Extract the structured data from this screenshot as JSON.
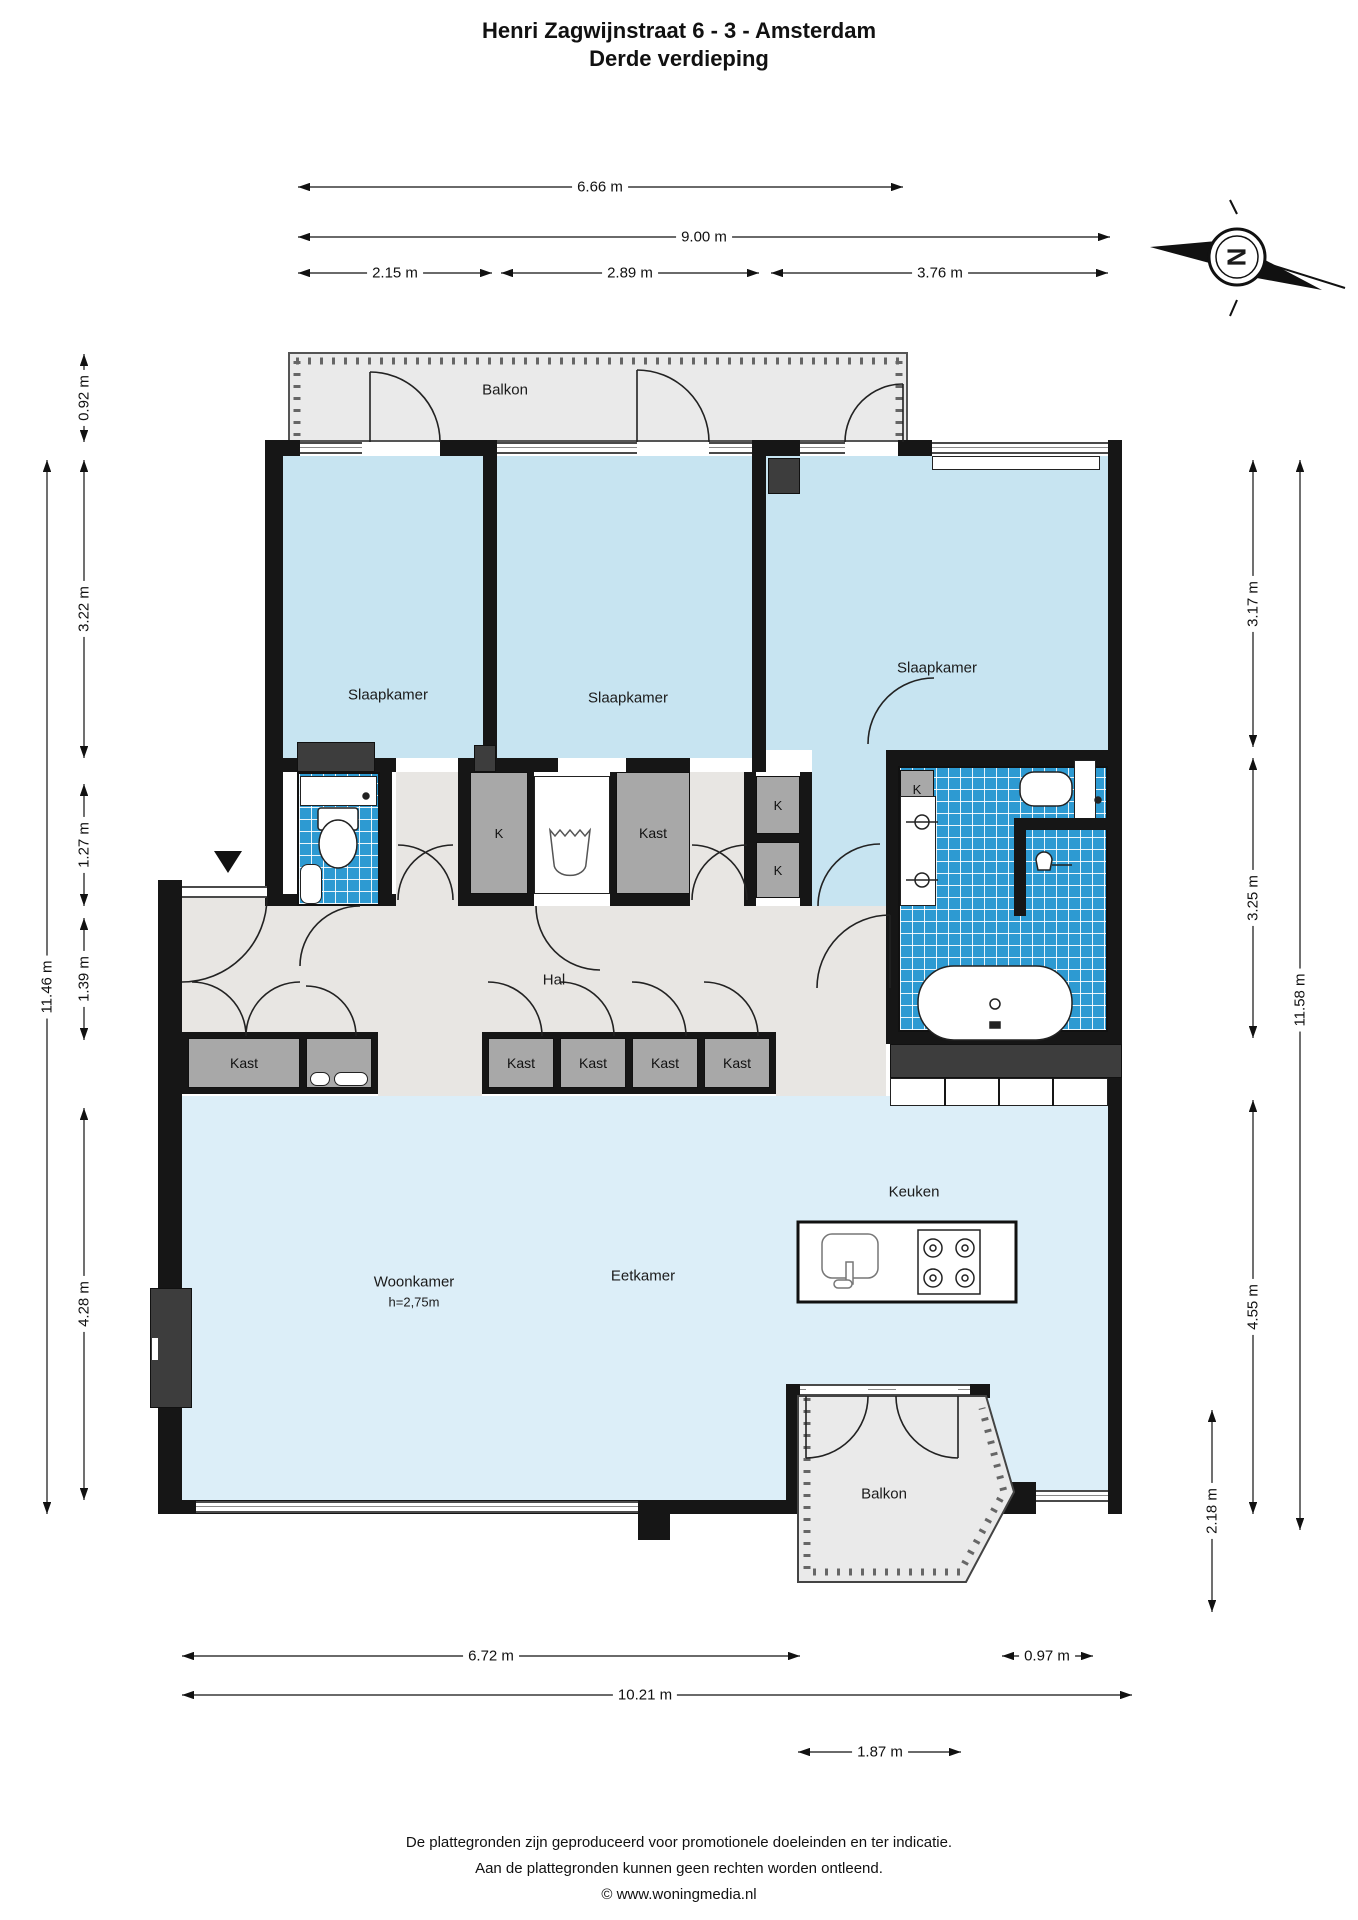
{
  "title": {
    "line1": "Henri Zagwijnstraat 6 - 3 - Amsterdam",
    "line2": "Derde verdieping"
  },
  "compass": {
    "letter": "N"
  },
  "rooms": {
    "balcony_top": "Balkon",
    "bedroom1": "Slaapkamer",
    "bedroom2": "Slaapkamer",
    "bedroom3": "Slaapkamer",
    "hall": "Hal",
    "living": "Woonkamer",
    "living_height": "h=2,75m",
    "dining": "Eetkamer",
    "kitchen": "Keuken",
    "balcony_bottom": "Balkon"
  },
  "closets": {
    "kast": "Kast",
    "k": "K"
  },
  "dimensions": {
    "top": {
      "balcony_width": "6.66 m",
      "total_width": "9.00 m",
      "bedroom1": "2.15 m",
      "bedroom2": "2.89 m",
      "bedroom3": "3.76 m"
    },
    "left": {
      "balcony_depth": "0.92 m",
      "bedrooms": "3.22 m",
      "closet_strip": "1.27 m",
      "hall": "1.39 m",
      "total": "11.46 m",
      "living": "4.28 m"
    },
    "right": {
      "bedroom3": "3.17 m",
      "bathroom": "3.25 m",
      "total": "11.58 m",
      "living": "4.55 m",
      "balcony": "2.18 m"
    },
    "bottom": {
      "living_width": "6.72 m",
      "total": "10.21 m",
      "window": "0.97 m",
      "balcony": "1.87 m"
    }
  },
  "footer": {
    "line1": "De plattegronden zijn geproduceerd voor promotionele doeleinden en ter indicatie.",
    "line2": "Aan de plattegronden kunnen geen rechten worden ontleend.",
    "line3": "© www.woningmedia.nl"
  },
  "colors": {
    "wall": "#161616",
    "room_blue": "#c7e4f1",
    "living_blue": "#dceef8",
    "tile_blue": "#2d9ad2",
    "hal_gray": "#e8e6e3",
    "balcony_gray": "#eaeaea",
    "closet_gray": "#a8a8a8",
    "dark_fixture": "#3d3d3d"
  }
}
